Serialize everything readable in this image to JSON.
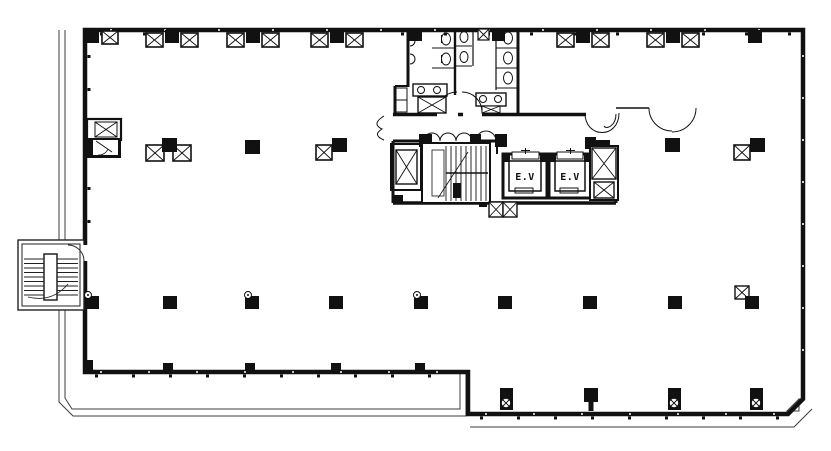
{
  "plan": {
    "name": "office-building-floor-plan",
    "elevators": [
      {
        "label": "E.V"
      },
      {
        "label": "E.V"
      }
    ],
    "colors": {
      "wall": "#111111",
      "thin": "#3c3c3c",
      "bg": "#ffffff"
    }
  },
  "geometry": {
    "top_columns": [
      {
        "cx": 172,
        "flanked": true
      },
      {
        "cx": 253,
        "flanked": true
      },
      {
        "cx": 337,
        "flanked": true
      },
      {
        "cx": 583,
        "flanked": true
      },
      {
        "cx": 673,
        "flanked": true
      },
      {
        "cx": 755,
        "flanked": false
      }
    ],
    "mid_columns": [
      {
        "x": 162,
        "y": 138,
        "xboxes": "both"
      },
      {
        "x": 245,
        "y": 140,
        "xboxes": "none"
      },
      {
        "x": 332,
        "y": 138,
        "xboxes": "left"
      },
      {
        "x": 665,
        "y": 138,
        "xboxes": "none"
      },
      {
        "x": 750,
        "y": 138,
        "xboxes": "left"
      }
    ],
    "lower_columns": [
      {
        "cx": 92,
        "tap": true,
        "xbox": false
      },
      {
        "cx": 170,
        "tap": false,
        "xbox": false
      },
      {
        "cx": 252,
        "tap": true,
        "xbox": false
      },
      {
        "cx": 336,
        "tap": false,
        "xbox": false
      },
      {
        "cx": 421,
        "tap": true,
        "xbox": false
      },
      {
        "cx": 505,
        "tap": false,
        "xbox": false
      },
      {
        "cx": 590,
        "tap": false,
        "xbox": false
      },
      {
        "cx": 675,
        "tap": false,
        "xbox": false
      },
      {
        "cx": 752,
        "tap": false,
        "xbox": true
      }
    ],
    "bottom_columns": [
      {
        "cx": 506,
        "tee": false
      },
      {
        "cx": 591,
        "tee": true
      },
      {
        "cx": 674,
        "tee": false
      },
      {
        "cx": 756,
        "tee": false
      }
    ],
    "wall_stubs": [
      88,
      168,
      250,
      336,
      420
    ]
  }
}
